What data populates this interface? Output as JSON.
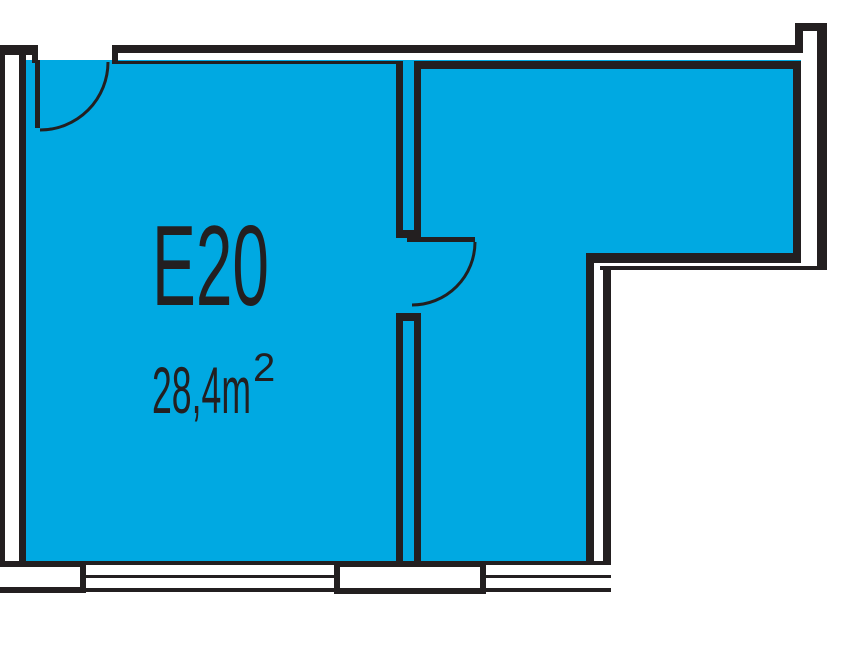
{
  "floor_plan": {
    "unit": {
      "id": "E20",
      "area": "28,4m",
      "area_sup": "2"
    },
    "colors": {
      "room_fill": "#00A9E2",
      "wall": "#231F20",
      "window_void": "#FFFFFF",
      "background": "#FFFFFF"
    }
  }
}
